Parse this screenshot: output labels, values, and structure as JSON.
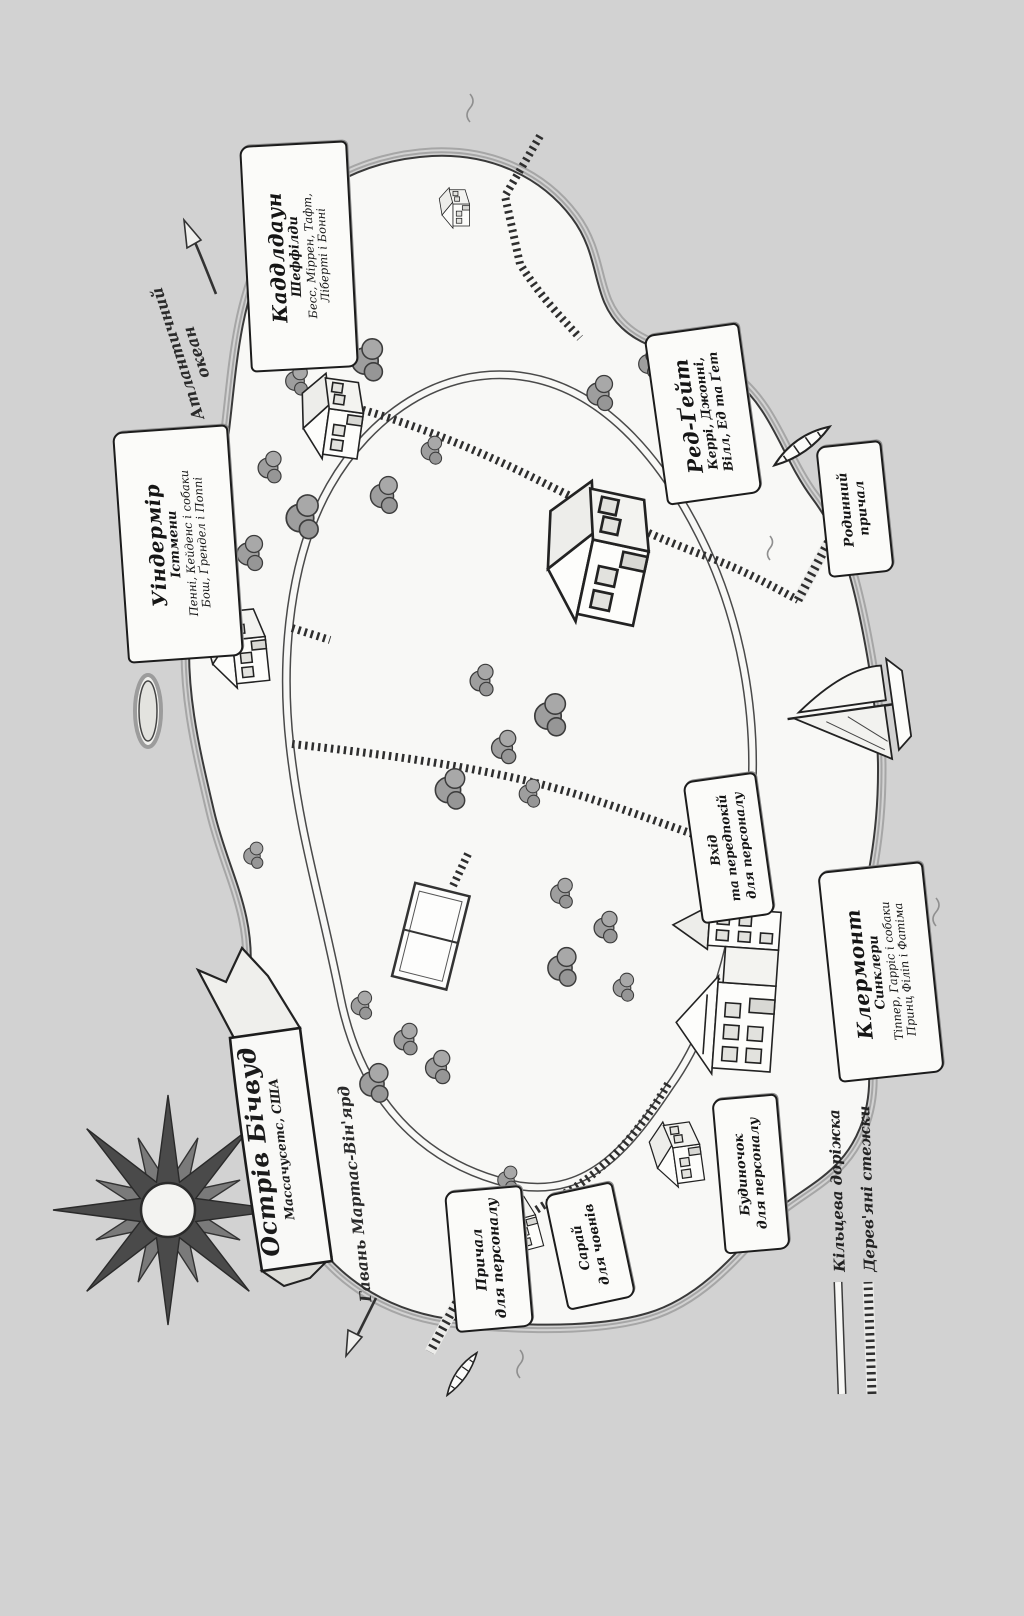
{
  "page": {
    "type": "illustrated-island-map",
    "language": "uk"
  },
  "title_banner": {
    "title": "Острів Бічвуд",
    "subtitle": "Массачусетс, США"
  },
  "direction_labels": {
    "ocean": {
      "line1": "Атлантичний",
      "line2": "океан"
    },
    "harbor": {
      "text": "Гавань Мартас-Він'ярд"
    }
  },
  "house_labels": {
    "cuddledown": {
      "name": "Каддлдаун",
      "family": "Шеффілди",
      "residents1": "Бесс, Міррен, Тафт,",
      "residents2": "Ліберті і Бонні"
    },
    "windemere": {
      "name": "Уіндермір",
      "family": "Істмени",
      "residents1": "Пенні, Кейденс і собаки",
      "residents2": "Бош, Ґрендел і Поппі"
    },
    "redgate": {
      "name": "Ред-Ґейт",
      "residents1": "Керрі, Джонні,",
      "residents2": "Вілл, Ед та Ґет"
    },
    "clermont": {
      "name": "Клермонт",
      "family": "Синклери",
      "residents1": "Тіппер, Гарріс і собаки",
      "residents2": "Принц Філіп і Фатіма"
    }
  },
  "place_labels": {
    "family_dock": {
      "line1": "Родинний",
      "line2": "причал"
    },
    "staff_entrance": {
      "line1": "Вхід",
      "line2": "та передпокій",
      "line3": "для персоналу"
    },
    "staff_cottage": {
      "line1": "Будиночок",
      "line2": "для персоналу"
    },
    "boat_shed": {
      "line1": "Сарай",
      "line2": "для човнів"
    },
    "staff_dock": {
      "line1": "Причал",
      "line2": "для персоналу"
    }
  },
  "legend": {
    "ring_road": "Кільцева доріжка",
    "boardwalks": "Дерев'яні стежки"
  },
  "colors": {
    "background": "#d2d2d2",
    "paper": "#f8f8f6",
    "ink": "#222222",
    "foliage": "#9e9e9e"
  }
}
